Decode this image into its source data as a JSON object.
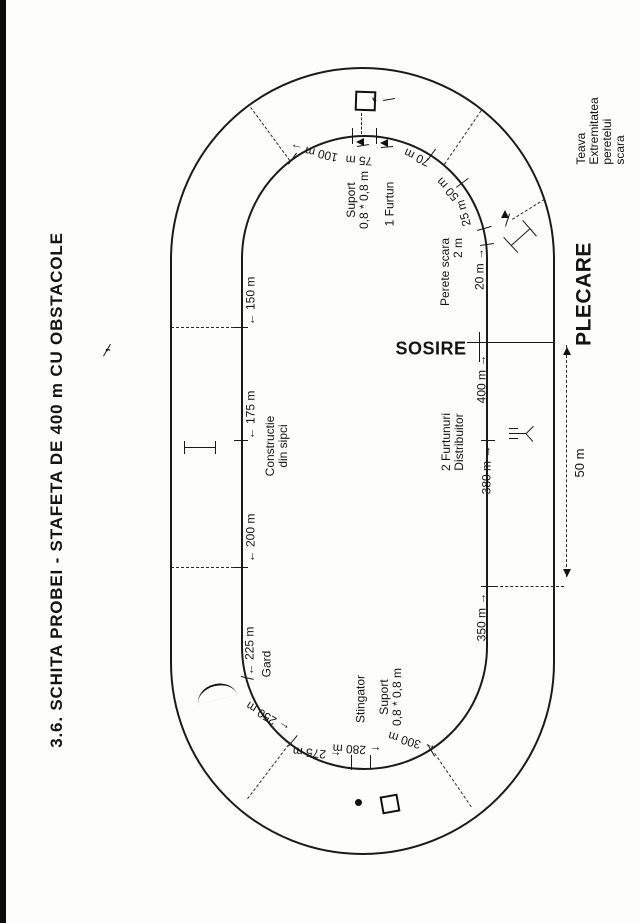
{
  "figure_title": "3.6.  SCHITA PROBEI - STAFETA DE 400 m  CU OBSTACOLE",
  "start_label": "PLECARE",
  "finish_label": "SOSIRE",
  "labels": [
    {
      "name": "page-title",
      "text": "3.6.  SCHITA PROBEI - STAFETA DE 400 m  CU OBSTACOLE",
      "x": 57,
      "y": 490,
      "rot": -90,
      "size": 17,
      "bold": true,
      "ls": 0.8
    },
    {
      "name": "title-cedilla-mark",
      "text": ",",
      "x": 104,
      "y": 350,
      "rot": -90,
      "size": 15,
      "bold": true
    },
    {
      "name": "label-sosire",
      "text": "SOSIRE",
      "x": 431,
      "y": 349,
      "rot": 0,
      "size": 18,
      "bold": true,
      "ls": 0.5
    },
    {
      "name": "label-plecare",
      "text": "PLECARE",
      "x": 585,
      "y": 294,
      "rot": -90,
      "size": 21,
      "bold": true,
      "ls": 0.5
    },
    {
      "name": "label-teava",
      "text": "Teava\nExtremitatea peretelui scara",
      "x": 601,
      "y": 131,
      "rot": -90,
      "size": 12,
      "align": "left"
    },
    {
      "name": "label-suport-top",
      "text": "Suport\n0,8 * 0,8 m",
      "x": 358,
      "y": 200,
      "rot": -90,
      "size": 12
    },
    {
      "name": "label-1-furtun",
      "text": "1 Furtun",
      "x": 390,
      "y": 204,
      "rot": -90,
      "size": 12
    },
    {
      "name": "label-100m",
      "text": "100 m →",
      "x": 314,
      "y": 152,
      "rot": 193,
      "size": 12
    },
    {
      "name": "label-75m",
      "text": "75 m",
      "x": 359,
      "y": 160,
      "rot": 184,
      "size": 12
    },
    {
      "name": "label-70m",
      "text": "70 m",
      "x": 417,
      "y": 157,
      "rot": 205,
      "size": 12
    },
    {
      "name": "label-50m",
      "text": "50 m",
      "x": 448,
      "y": 189,
      "rot": 228,
      "size": 12
    },
    {
      "name": "label-25m",
      "text": "25 m",
      "x": 464,
      "y": 213,
      "rot": -105,
      "size": 12
    },
    {
      "name": "label-20m",
      "text": "20 m →",
      "x": 480,
      "y": 269,
      "rot": -90,
      "size": 12
    },
    {
      "name": "label-perete-scara",
      "text": "Perete scara\n2 m",
      "x": 452,
      "y": 272,
      "rot": -90,
      "size": 12,
      "align": "right"
    },
    {
      "name": "label-400m",
      "text": "400 m →",
      "x": 482,
      "y": 379,
      "rot": -90,
      "size": 12
    },
    {
      "name": "label-2-furtunuri",
      "text": "2 Furtunuri\nDistribuitor",
      "x": 453,
      "y": 442,
      "rot": -90,
      "size": 12
    },
    {
      "name": "label-380m",
      "text": "380 m →",
      "x": 487,
      "y": 470,
      "rot": -90,
      "size": 12
    },
    {
      "name": "label-350m",
      "text": "350 m →",
      "x": 482,
      "y": 617,
      "rot": -90,
      "size": 12
    },
    {
      "name": "label-dim-50m",
      "text": "50 m",
      "x": 580,
      "y": 463,
      "rot": -90,
      "size": 13
    },
    {
      "name": "label-150m",
      "text": "← 150 m",
      "x": 251,
      "y": 301,
      "rot": -90,
      "size": 12
    },
    {
      "name": "label-175m",
      "text": "← 175 m",
      "x": 251,
      "y": 415,
      "rot": -90,
      "size": 12
    },
    {
      "name": "label-constructie",
      "text": "Constructie\ndin sipci",
      "x": 277,
      "y": 446,
      "rot": -90,
      "size": 12
    },
    {
      "name": "label-200m",
      "text": "← 200 m",
      "x": 251,
      "y": 538,
      "rot": -90,
      "size": 12
    },
    {
      "name": "label-225m",
      "text": "← 225 m",
      "x": 250,
      "y": 651,
      "rot": -90,
      "size": 12
    },
    {
      "name": "label-gard",
      "text": "Gard",
      "x": 267,
      "y": 664,
      "rot": -90,
      "size": 12
    },
    {
      "name": "label-250m",
      "text": "← 250 m",
      "x": 268,
      "y": 717,
      "rot": 212,
      "size": 12
    },
    {
      "name": "label-275m",
      "text": "← 275 m",
      "x": 317,
      "y": 753,
      "rot": 186,
      "size": 12
    },
    {
      "name": "label-280m",
      "text": "← 280 m",
      "x": 357,
      "y": 749,
      "rot": 183,
      "size": 12
    },
    {
      "name": "label-300m",
      "text": "← 300 m",
      "x": 412,
      "y": 742,
      "rot": 197,
      "size": 12
    },
    {
      "name": "label-stingator",
      "text": "Stingator",
      "x": 361,
      "y": 699,
      "rot": -90,
      "size": 12
    },
    {
      "name": "label-suport-bottom",
      "text": "Suport\n0,8 * 0,8 m",
      "x": 391,
      "y": 697,
      "rot": -90,
      "size": 12
    },
    {
      "name": "obstacle-comma-mark",
      "text": ",",
      "x": 377,
      "y": 103,
      "rot": 140,
      "size": 16,
      "bold": true
    }
  ]
}
